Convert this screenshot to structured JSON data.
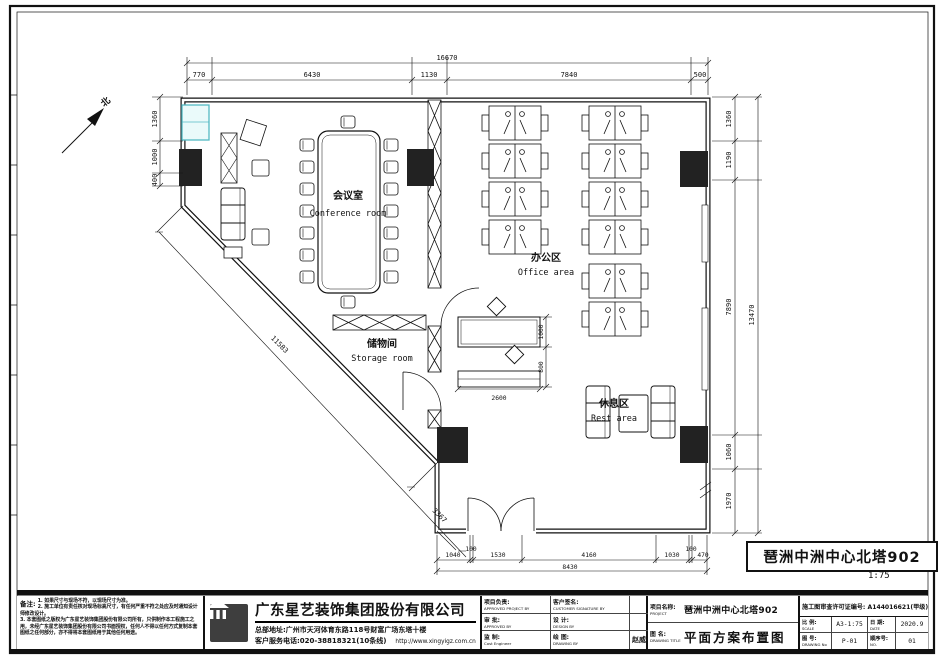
{
  "compass": {
    "north": "北"
  },
  "rooms": {
    "conference": {
      "zh": "会议室",
      "en": "Conference room"
    },
    "office": {
      "zh": "办公区",
      "en": "Office area"
    },
    "storage": {
      "zh": "储物间",
      "en": "Storage room"
    },
    "rest": {
      "zh": "休息区",
      "en": "Rest area"
    }
  },
  "dims": {
    "top": {
      "total": "16670",
      "segs": [
        "770",
        "6430",
        "1130",
        "7840",
        "500"
      ]
    },
    "bottom": {
      "total": "8430",
      "segs": [
        "1040",
        "100",
        "1530",
        "4160",
        "1030",
        "100",
        "470"
      ]
    },
    "left": {
      "segs": [
        "1360",
        "1000",
        "400"
      ]
    },
    "right": {
      "total": "13470",
      "segs": [
        "1360",
        "1190",
        "7890",
        "1060",
        "1970"
      ]
    },
    "diag": {
      "upper": "11583",
      "lower": "3367"
    },
    "interior": {
      "d1": "1000",
      "d2": "800",
      "d3": "2600"
    }
  },
  "title_box": {
    "name": "琶洲中洲中心北塔902",
    "scale": "1:75"
  },
  "notes": {
    "heading": "备注:",
    "items": [
      "1. 如果尺寸与现场不符，以现场尺寸为准。",
      "2. 施工单位有责任核对现场标高尺寸，有任何严重不符之处应及时通知设计师修改设计。",
      "3. 本套图纸之版权为广东星艺装饰集团股份有限公司所有，只供制作本工程施工之用，未经广东星艺装饰集团股份有限公司书面授权，任何人不得以任何方式复制本套图纸之任何部分，亦不得将本套图纸用于其他任何用途。"
    ]
  },
  "company": {
    "name": "广东星艺装饰集团股份有限公司",
    "address": "总部地址:广州市天河体育东路118号财富广场东塔十楼",
    "phone": "客户服务电话:020-38818321(10条线)",
    "website": "http://www.xingyigz.com.cn"
  },
  "title_block": {
    "project_lead_zh": "项目负责:",
    "project_lead_en": "APPROVED PROJECT BY",
    "customer_zh": "客户签名:",
    "customer_en": "CUSTOMER SIGNATURE BY",
    "approve_zh": "审 批:",
    "approve_en": "APPROVED BY",
    "design_zh": "设 计:",
    "design_en": "DESIGN BY",
    "supervise_zh": "监 制:",
    "supervise_en": "Cost Engineer",
    "draw_zh": "绘 图:",
    "draw_en": "DRAWING BY",
    "draw_value": "赵威",
    "project_zh": "项目名称:",
    "project_en": "PROJECT",
    "project_value": "琶洲中洲中心北塔902",
    "dwgtitle_zh": "图 名:",
    "dwgtitle_en": "DRAWING TITLE",
    "dwgtitle_value": "平面方案布置图",
    "permit": "施工图审查许可证编号: A144016621(甲级)",
    "scale_zh": "比 例:",
    "scale_en": "SCALE",
    "scale_value": "A3-1:75",
    "date_zh": "日 期:",
    "date_en": "DATE",
    "date_value": "2020.9",
    "dwgno_zh": "图 号:",
    "dwgno_en": "DRAWING No",
    "dwgno_value": "P-01",
    "seq_zh": "顺序号:",
    "seq_en": "NO.",
    "seq_value": "01"
  }
}
